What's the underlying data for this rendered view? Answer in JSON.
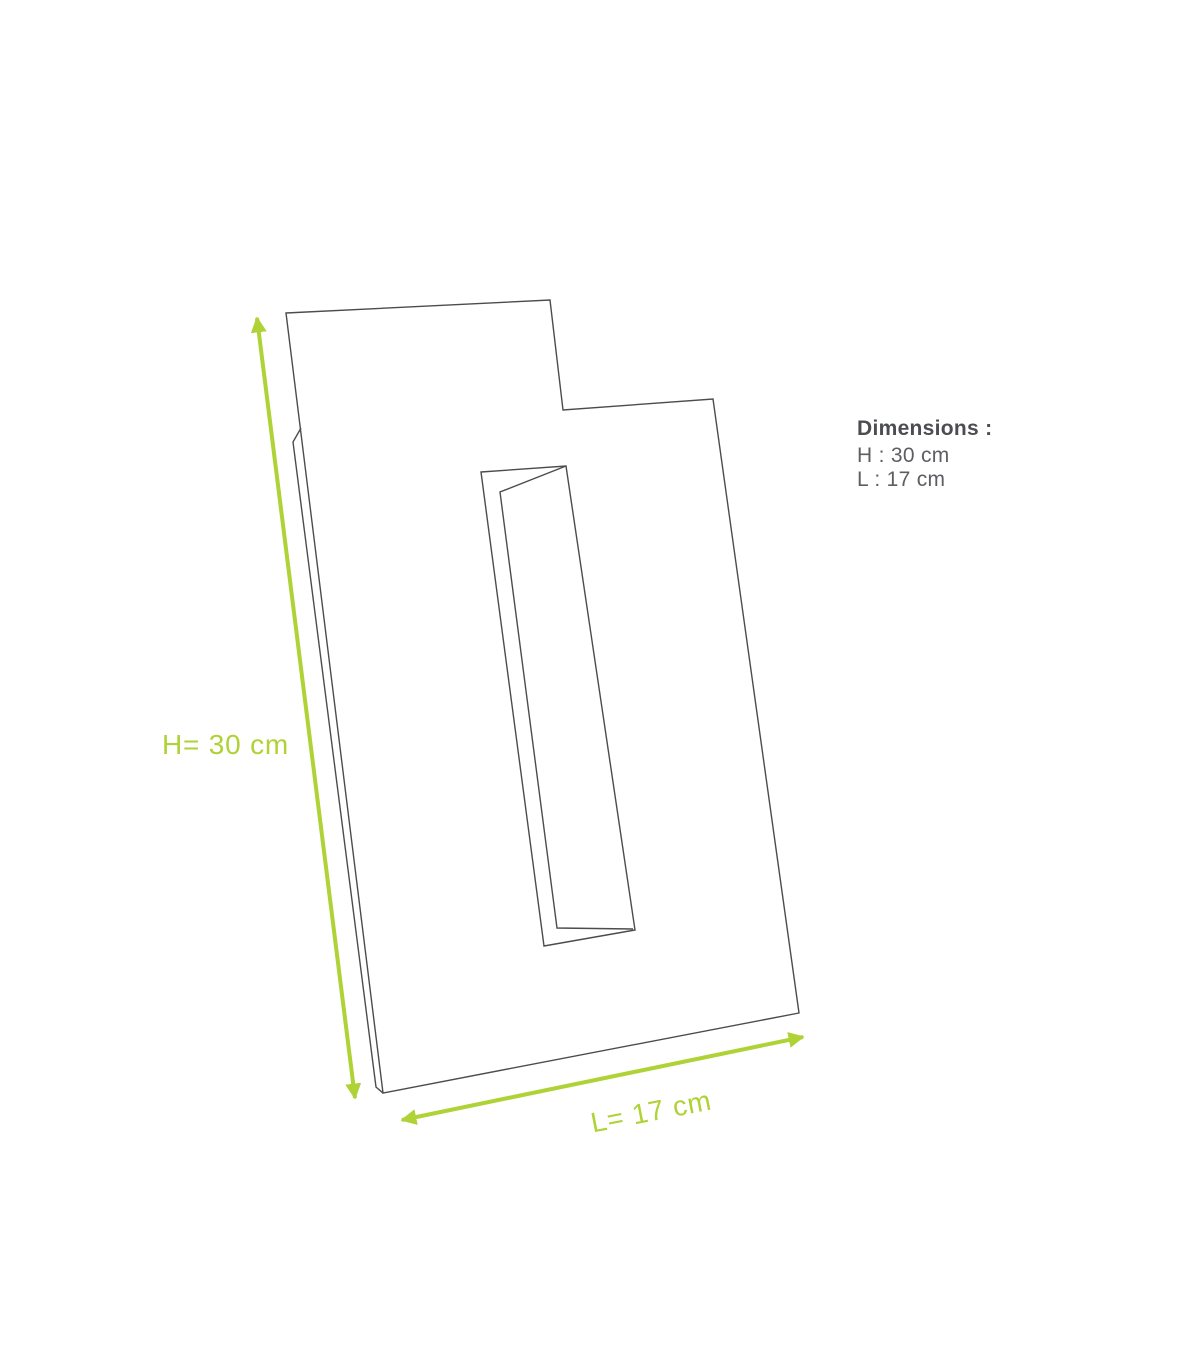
{
  "diagram": {
    "annotations": {
      "height_label": "H= 30 cm",
      "length_label": "L= 17 cm"
    },
    "info_panel": {
      "title": "Dimensions :",
      "lines": [
        "H : 30 cm",
        "L : 17 cm"
      ]
    },
    "dimensions": {
      "height_cm": 30,
      "length_cm": 17
    },
    "colors": {
      "accent_green": "#afd236",
      "line_gray": "#4b4c4f",
      "title_gray": "#4c4d51",
      "text_gray": "#5d5e62",
      "background": "#ffffff"
    }
  }
}
